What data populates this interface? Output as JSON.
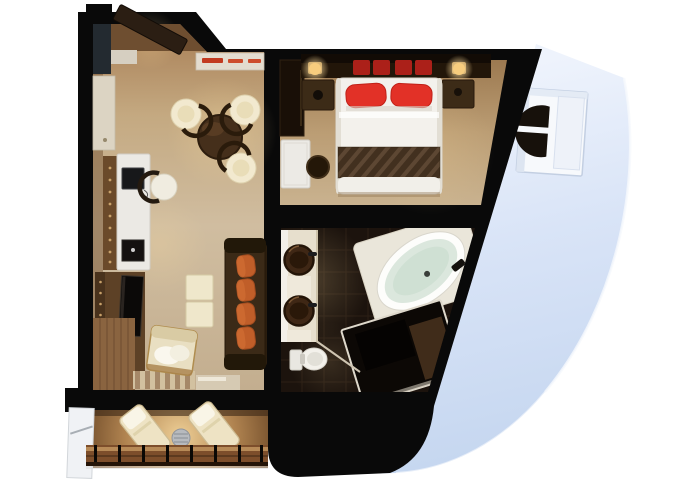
{
  "page": {
    "title": "Suite floor plan",
    "background_color": "#ffffff"
  },
  "plan": {
    "view": "top-down 3D rendered floor plan of a ship cabin suite",
    "rooms": [
      {
        "id": "entry",
        "label": "Entry",
        "furniture": [
          "entry-door",
          "closet",
          "console-shelf-with-red-items"
        ]
      },
      {
        "id": "living-room",
        "label": "Living room",
        "furniture": [
          "wall-cabinet",
          "desk",
          "laptop",
          "desk-chair",
          "dining-table",
          "barrel-chair-1",
          "barrel-chair-2",
          "barrel-chair-3",
          "media-cabinet",
          "tv",
          "sofa",
          "orange-cushions",
          "ottoman-1",
          "ottoman-2",
          "armchair",
          "striped-rug"
        ]
      },
      {
        "id": "bedroom",
        "label": "Bedroom",
        "furniture": [
          "wardrobe",
          "headboard",
          "bedside-lamp-left",
          "bedside-lamp-right",
          "red-bolster-cushions",
          "double-bed",
          "red-pillow-left",
          "red-pillow-right",
          "bed-runner",
          "nightstand-left",
          "nightstand-right",
          "vanity-table",
          "stool"
        ]
      },
      {
        "id": "bathroom",
        "label": "Bathroom",
        "furniture": [
          "vanity-counter",
          "vessel-sink-upper",
          "vessel-sink-lower",
          "bathtub",
          "toilet",
          "shower-enclosure",
          "bath-mat"
        ]
      },
      {
        "id": "balcony",
        "label": "Balcony",
        "furniture": [
          "lounge-chair-left",
          "lounge-chair-right",
          "side-table",
          "wood-railing",
          "frosted-glass-divider"
        ]
      },
      {
        "id": "hull",
        "label": "Ship hull",
        "furniture": [
          "porthole-window"
        ]
      }
    ],
    "colors": {
      "structure_black": "#090909",
      "hull_blue": "#cfdef4",
      "carpet_tan": "#c7b294",
      "dark_wood": "#5c3f24",
      "cream_upholstery": "#efe5c8",
      "pillow_red": "#e23127",
      "cushion_orange": "#c05e29",
      "tub_water": "#d9e6dc",
      "bath_tile": "#1c130d"
    }
  }
}
